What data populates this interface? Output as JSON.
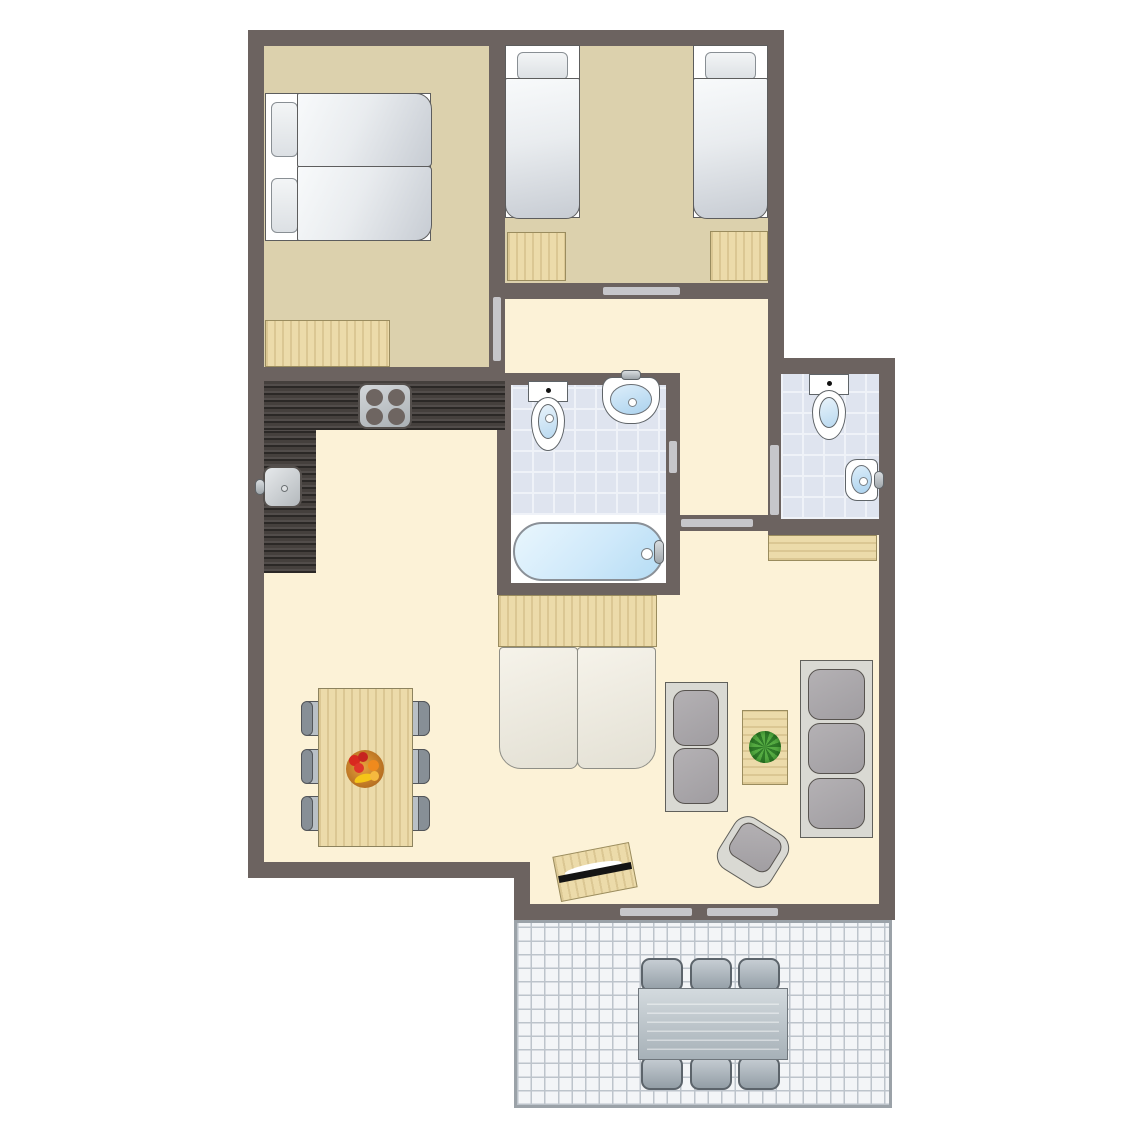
{
  "title": "apartment-floor-plan",
  "colors": {
    "wall": "#6c6360",
    "floor-bedroom": "#dcd1ad",
    "floor-living": "#fcf2d7",
    "bath-tile": "#dfe4ef",
    "bath-tile-line": "#eff2f8",
    "terrace-tile": "#f3f5f7",
    "terrace-line": "#bdc4cb",
    "terrace-border": "#9ba2a8",
    "wood": "#ecdbaa",
    "wood-border": "#9a8c5e",
    "counter": "#45403d",
    "door-mark": "#c6c6ca",
    "water": "#cfe9fa",
    "sofa-frame": "#d9d9d3",
    "sofa-cushion": "#a09da1",
    "chair-seat": "#b9c0c6"
  },
  "inventory": {
    "rooms": [
      {
        "name": "bedroom-double"
      },
      {
        "name": "bedroom-twin"
      },
      {
        "name": "hallway"
      },
      {
        "name": "bathroom"
      },
      {
        "name": "separate-toilet"
      },
      {
        "name": "living-dining-kitchen"
      },
      {
        "name": "terrace"
      }
    ],
    "furniture": [
      {
        "name": "double-bed",
        "room": "bedroom-double"
      },
      {
        "name": "wardrobe",
        "room": "bedroom-double"
      },
      {
        "name": "single-bed",
        "room": "bedroom-twin",
        "count": 2
      },
      {
        "name": "nightstand",
        "room": "bedroom-twin",
        "count": 2
      },
      {
        "name": "toilet",
        "room": "bathroom"
      },
      {
        "name": "washbasin",
        "room": "bathroom"
      },
      {
        "name": "bathtub",
        "room": "bathroom"
      },
      {
        "name": "toilet",
        "room": "separate-toilet"
      },
      {
        "name": "corner-washbasin",
        "room": "separate-toilet"
      },
      {
        "name": "kitchen-counter",
        "room": "living-dining-kitchen"
      },
      {
        "name": "stove-4-burners",
        "room": "living-dining-kitchen"
      },
      {
        "name": "kitchen-sink",
        "room": "living-dining-kitchen"
      },
      {
        "name": "sideboard",
        "room": "living-dining-kitchen",
        "count": 2
      },
      {
        "name": "sofa-bed",
        "room": "living-dining-kitchen"
      },
      {
        "name": "sofa-2-seat",
        "room": "living-dining-kitchen"
      },
      {
        "name": "sofa-3-seat",
        "room": "living-dining-kitchen"
      },
      {
        "name": "coffee-table-with-plant",
        "room": "living-dining-kitchen"
      },
      {
        "name": "armchair",
        "room": "living-dining-kitchen"
      },
      {
        "name": "tv-stand",
        "room": "living-dining-kitchen"
      },
      {
        "name": "dining-table-with-fruit-bowl",
        "room": "living-dining-kitchen"
      },
      {
        "name": "dining-chair",
        "room": "living-dining-kitchen",
        "count": 6
      },
      {
        "name": "outdoor-table",
        "room": "terrace"
      },
      {
        "name": "outdoor-chair",
        "room": "terrace",
        "count": 6
      }
    ]
  }
}
